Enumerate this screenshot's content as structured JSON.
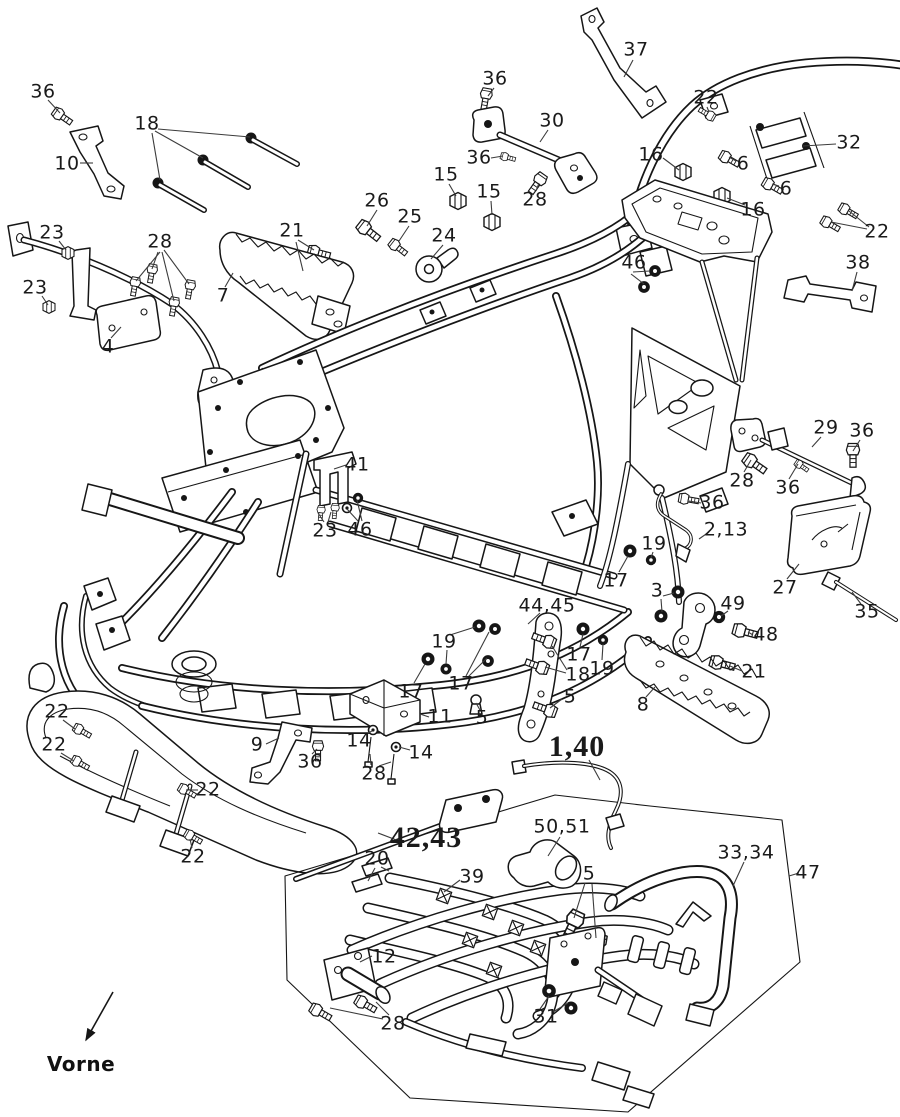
{
  "diagram": {
    "kind": "exploded-parts-diagram",
    "front_marker_text": "Vorne",
    "colors": {
      "ink": "#161616",
      "leader": "#3c3c3c",
      "background": "#ffffff"
    }
  },
  "front_marker": {
    "text": "Vorne",
    "x": 81,
    "y": 1064,
    "arrow": {
      "x1": 113,
      "y1": 992,
      "x2": 86,
      "y2": 1040
    }
  },
  "labels": [
    {
      "t": "36",
      "x": 43,
      "y": 92
    },
    {
      "t": "10",
      "x": 67,
      "y": 164
    },
    {
      "t": "18",
      "x": 147,
      "y": 124
    },
    {
      "t": "23",
      "x": 52,
      "y": 233
    },
    {
      "t": "28",
      "x": 160,
      "y": 242
    },
    {
      "t": "21",
      "x": 292,
      "y": 231
    },
    {
      "t": "23",
      "x": 35,
      "y": 288
    },
    {
      "t": "4",
      "x": 108,
      "y": 347
    },
    {
      "t": "7",
      "x": 223,
      "y": 296
    },
    {
      "t": "26",
      "x": 377,
      "y": 201
    },
    {
      "t": "25",
      "x": 410,
      "y": 217
    },
    {
      "t": "24",
      "x": 444,
      "y": 236
    },
    {
      "t": "15",
      "x": 446,
      "y": 175
    },
    {
      "t": "15",
      "x": 489,
      "y": 192
    },
    {
      "t": "36",
      "x": 495,
      "y": 79
    },
    {
      "t": "30",
      "x": 552,
      "y": 121
    },
    {
      "t": "36",
      "x": 479,
      "y": 158
    },
    {
      "t": "28",
      "x": 535,
      "y": 200
    },
    {
      "t": "37",
      "x": 636,
      "y": 50
    },
    {
      "t": "22",
      "x": 706,
      "y": 98
    },
    {
      "t": "16",
      "x": 651,
      "y": 155
    },
    {
      "t": "6",
      "x": 743,
      "y": 164
    },
    {
      "t": "6",
      "x": 786,
      "y": 189
    },
    {
      "t": "16",
      "x": 753,
      "y": 210
    },
    {
      "t": "32",
      "x": 849,
      "y": 143
    },
    {
      "t": "22",
      "x": 877,
      "y": 232
    },
    {
      "t": "46",
      "x": 634,
      "y": 263
    },
    {
      "t": "38",
      "x": 858,
      "y": 263
    },
    {
      "t": "41",
      "x": 357,
      "y": 465
    },
    {
      "t": "23",
      "x": 325,
      "y": 531
    },
    {
      "t": "46",
      "x": 360,
      "y": 530
    },
    {
      "t": "29",
      "x": 826,
      "y": 428
    },
    {
      "t": "36",
      "x": 862,
      "y": 431
    },
    {
      "t": "28",
      "x": 742,
      "y": 481
    },
    {
      "t": "36",
      "x": 788,
      "y": 488
    },
    {
      "t": "36",
      "x": 712,
      "y": 503
    },
    {
      "t": "2,13",
      "x": 726,
      "y": 530
    },
    {
      "t": "19",
      "x": 654,
      "y": 544
    },
    {
      "t": "17",
      "x": 616,
      "y": 581
    },
    {
      "t": "3",
      "x": 657,
      "y": 591
    },
    {
      "t": "49",
      "x": 733,
      "y": 604
    },
    {
      "t": "48",
      "x": 766,
      "y": 635
    },
    {
      "t": "27",
      "x": 785,
      "y": 588
    },
    {
      "t": "35",
      "x": 867,
      "y": 612
    },
    {
      "t": "21",
      "x": 754,
      "y": 672
    },
    {
      "t": "8",
      "x": 643,
      "y": 705
    },
    {
      "t": "44,45",
      "x": 547,
      "y": 606
    },
    {
      "t": "19",
      "x": 444,
      "y": 642
    },
    {
      "t": "17",
      "x": 411,
      "y": 692
    },
    {
      "t": "17",
      "x": 461,
      "y": 684
    },
    {
      "t": "5",
      "x": 482,
      "y": 718
    },
    {
      "t": "11",
      "x": 440,
      "y": 717
    },
    {
      "t": "17",
      "x": 579,
      "y": 655
    },
    {
      "t": "18",
      "x": 578,
      "y": 675
    },
    {
      "t": "19",
      "x": 602,
      "y": 669
    },
    {
      "t": "5",
      "x": 570,
      "y": 697
    },
    {
      "t": "14",
      "x": 359,
      "y": 741
    },
    {
      "t": "14",
      "x": 421,
      "y": 753
    },
    {
      "t": "28",
      "x": 374,
      "y": 774
    },
    {
      "t": "9",
      "x": 257,
      "y": 745
    },
    {
      "t": "36",
      "x": 310,
      "y": 762
    },
    {
      "t": "22",
      "x": 57,
      "y": 712
    },
    {
      "t": "22",
      "x": 54,
      "y": 745
    },
    {
      "t": "22",
      "x": 208,
      "y": 790
    },
    {
      "t": "22",
      "x": 193,
      "y": 857
    },
    {
      "t": "1,40",
      "x": 577,
      "y": 747,
      "big": true
    },
    {
      "t": "42,43",
      "x": 426,
      "y": 838,
      "big": true
    },
    {
      "t": "20",
      "x": 377,
      "y": 859
    },
    {
      "t": "39",
      "x": 472,
      "y": 877
    },
    {
      "t": "50,51",
      "x": 562,
      "y": 827
    },
    {
      "t": "5",
      "x": 589,
      "y": 874
    },
    {
      "t": "12",
      "x": 384,
      "y": 957
    },
    {
      "t": "28",
      "x": 393,
      "y": 1024
    },
    {
      "t": "31",
      "x": 546,
      "y": 1017
    },
    {
      "t": "33,34",
      "x": 746,
      "y": 853
    },
    {
      "t": "47",
      "x": 808,
      "y": 873
    }
  ],
  "leaders": [
    [
      48,
      100,
      60,
      113
    ],
    [
      80,
      163,
      93,
      163
    ],
    [
      152,
      133,
      160,
      180
    ],
    [
      155,
      131,
      203,
      158
    ],
    [
      158,
      129,
      250,
      137
    ],
    [
      59,
      241,
      66,
      250
    ],
    [
      160,
      252,
      136,
      281
    ],
    [
      158,
      252,
      152,
      269
    ],
    [
      162,
      252,
      174,
      301
    ],
    [
      164,
      250,
      189,
      284
    ],
    [
      298,
      240,
      314,
      250
    ],
    [
      296,
      242,
      303,
      271
    ],
    [
      42,
      296,
      48,
      305
    ],
    [
      111,
      338,
      121,
      327
    ],
    [
      225,
      287,
      233,
      273
    ],
    [
      377,
      210,
      367,
      226
    ],
    [
      409,
      226,
      399,
      241
    ],
    [
      443,
      245,
      431,
      259
    ],
    [
      449,
      184,
      456,
      196
    ],
    [
      491,
      201,
      492,
      215
    ],
    [
      494,
      88,
      488,
      96
    ],
    [
      548,
      130,
      540,
      142
    ],
    [
      491,
      158,
      503,
      156
    ],
    [
      536,
      191,
      539,
      183
    ],
    [
      633,
      60,
      624,
      77
    ],
    [
      707,
      107,
      709,
      112
    ],
    [
      663,
      158,
      679,
      170
    ],
    [
      736,
      161,
      729,
      157
    ],
    [
      779,
      186,
      772,
      184
    ],
    [
      745,
      205,
      727,
      198
    ],
    [
      836,
      144,
      803,
      146
    ],
    [
      869,
      227,
      849,
      211
    ],
    [
      867,
      229,
      831,
      222
    ],
    [
      633,
      272,
      650,
      271
    ],
    [
      631,
      274,
      644,
      284
    ],
    [
      857,
      272,
      852,
      291
    ],
    [
      346,
      465,
      334,
      469
    ],
    [
      324,
      522,
      318,
      513
    ],
    [
      328,
      522,
      331,
      512
    ],
    [
      358,
      521,
      347,
      509
    ],
    [
      362,
      521,
      357,
      500
    ],
    [
      821,
      437,
      812,
      447
    ],
    [
      860,
      440,
      853,
      451
    ],
    [
      744,
      472,
      751,
      460
    ],
    [
      789,
      479,
      798,
      464
    ],
    [
      701,
      503,
      689,
      501
    ],
    [
      709,
      532,
      699,
      539
    ],
    [
      653,
      552,
      651,
      558
    ],
    [
      619,
      572,
      628,
      556
    ],
    [
      663,
      596,
      674,
      593
    ],
    [
      661,
      599,
      662,
      612
    ],
    [
      728,
      611,
      721,
      616
    ],
    [
      753,
      635,
      748,
      632
    ],
    [
      787,
      579,
      799,
      564
    ],
    [
      861,
      604,
      852,
      592
    ],
    [
      742,
      671,
      730,
      666
    ],
    [
      646,
      697,
      655,
      687
    ],
    [
      540,
      613,
      528,
      624
    ],
    [
      450,
      635,
      475,
      627
    ],
    [
      447,
      650,
      446,
      664
    ],
    [
      414,
      683,
      425,
      664
    ],
    [
      466,
      676,
      489,
      632
    ],
    [
      467,
      678,
      487,
      658
    ],
    [
      480,
      710,
      476,
      703
    ],
    [
      429,
      717,
      420,
      714
    ],
    [
      580,
      647,
      583,
      634
    ],
    [
      567,
      670,
      552,
      646
    ],
    [
      566,
      673,
      545,
      667
    ],
    [
      602,
      660,
      603,
      644
    ],
    [
      562,
      699,
      550,
      708
    ],
    [
      366,
      734,
      372,
      731
    ],
    [
      410,
      750,
      399,
      747
    ],
    [
      371,
      765,
      370,
      754
    ],
    [
      379,
      766,
      391,
      762
    ],
    [
      266,
      744,
      279,
      738
    ],
    [
      312,
      754,
      317,
      749
    ],
    [
      63,
      720,
      75,
      729
    ],
    [
      61,
      753,
      74,
      761
    ],
    [
      198,
      790,
      186,
      790
    ],
    [
      192,
      848,
      190,
      839
    ],
    [
      589,
      760,
      600,
      780
    ],
    [
      399,
      841,
      378,
      833
    ],
    [
      381,
      867,
      389,
      871
    ],
    [
      375,
      868,
      368,
      881
    ],
    [
      460,
      880,
      444,
      892
    ],
    [
      560,
      837,
      548,
      856
    ],
    [
      585,
      883,
      574,
      918
    ],
    [
      592,
      884,
      596,
      938
    ],
    [
      372,
      956,
      360,
      962
    ],
    [
      389,
      1015,
      376,
      1002
    ],
    [
      383,
      1019,
      330,
      1008
    ],
    [
      540,
      1009,
      549,
      996
    ],
    [
      553,
      1012,
      568,
      1003
    ],
    [
      744,
      862,
      733,
      886
    ],
    [
      799,
      873,
      789,
      876
    ]
  ]
}
